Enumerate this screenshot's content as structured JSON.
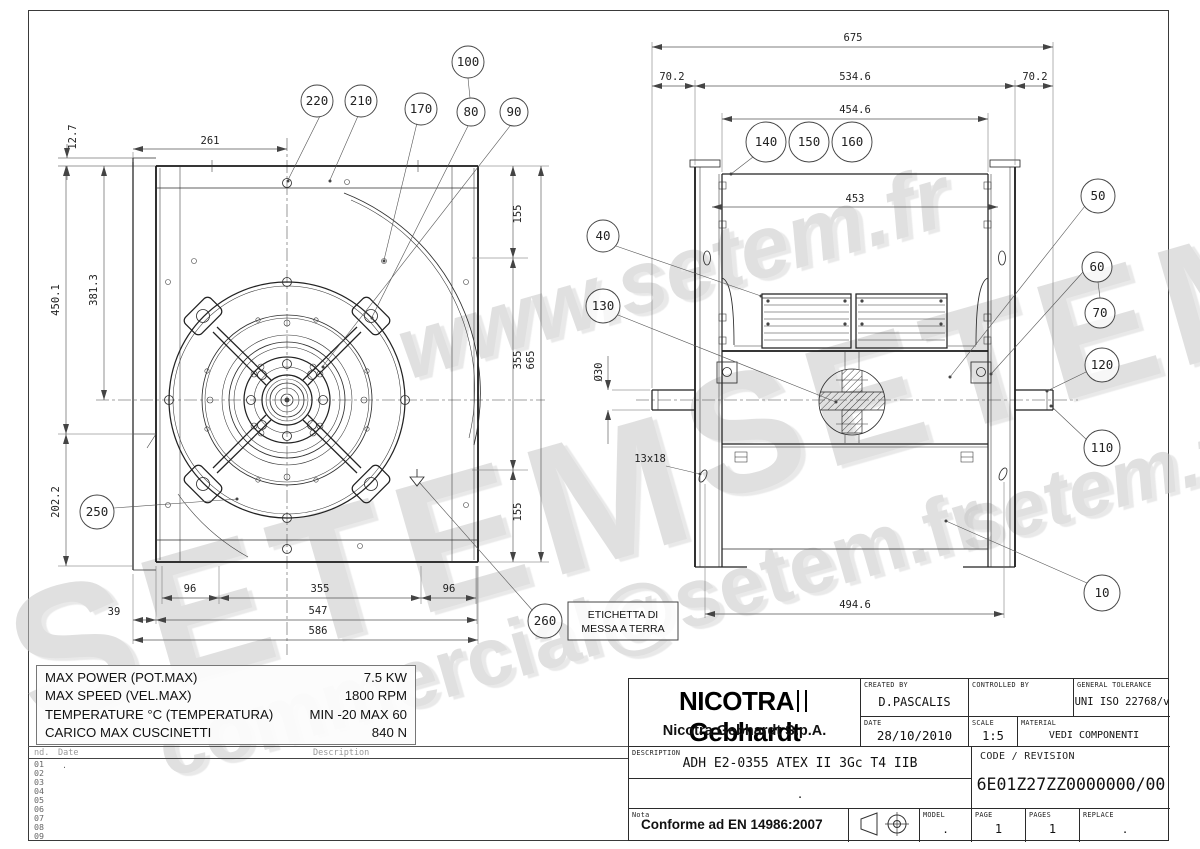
{
  "watermarks": {
    "w1": "www.setem.fr",
    "w2": "SETEM",
    "w3": "SETEM",
    "w4": "commercial@setem.fr",
    "w5": "setem.fr"
  },
  "front_view": {
    "balloons": {
      "b220": "220",
      "b210": "210",
      "b170": "170",
      "b80": "80",
      "b90": "90",
      "b100": "100",
      "b250": "250",
      "b260": "260"
    },
    "dims": {
      "d12_7": "12.7",
      "d261": "261",
      "d450": "450.1",
      "d381": "381.3",
      "d202": "202.2",
      "d155t": "155",
      "d355r": "355",
      "d155b": "155",
      "d665": "665",
      "d96l": "96",
      "d355b": "355",
      "d96r": "96",
      "d39": "39",
      "d547": "547",
      "d586": "586"
    },
    "ground_label_1": "ETICHETTA DI",
    "ground_label_2": "MESSA A TERRA"
  },
  "side_view": {
    "balloons": {
      "b140": "140",
      "b150": "150",
      "b160": "160",
      "b40": "40",
      "b130": "130",
      "b50": "50",
      "b60": "60",
      "b70": "70",
      "b120": "120",
      "b110": "110",
      "b10": "10"
    },
    "dims": {
      "d675": "675",
      "d70l": "70.2",
      "d534": "534.6",
      "d70r": "70.2",
      "d454": "454.6",
      "d453": "453",
      "d30": "Ø30",
      "d13": "13x18",
      "d494": "494.6"
    }
  },
  "spec_table": {
    "rows": [
      {
        "label": "MAX POWER (POT.MAX)",
        "value": "7.5 KW"
      },
      {
        "label": "MAX SPEED (VEL.MAX)",
        "value": "1800 RPM"
      },
      {
        "label": "TEMPERATURE °C (TEMPERATURA)",
        "value": "MIN -20 MAX 60"
      },
      {
        "label": "CARICO MAX CUSCINETTI",
        "value": "840 N"
      }
    ]
  },
  "revision_table": {
    "col_index": "nd.",
    "col_date": "Date",
    "col_desc": "Description",
    "rows": [
      "01",
      "02",
      "03",
      "04",
      "05",
      "06",
      "07",
      "08",
      "09"
    ],
    "row1_entry": "."
  },
  "title_block": {
    "brand_left": "NICOTRA",
    "brand_right": "Gebhardt",
    "company": "Nicotra Gebhardt S.p.A.",
    "created_by_label": "CREATED BY",
    "created_by": "D.PASCALIS",
    "controlled_by_label": "CONTROLLED BY",
    "controlled_by": "",
    "tolerance_label": "GENERAL TOLERANCE",
    "tolerance": "UNI ISO 22768/v",
    "date_label": "DATE",
    "date": "28/10/2010",
    "scale_label": "SCALE",
    "scale": "1:5",
    "material_label": "MATERIAL",
    "material": "VEDI COMPONENTI",
    "description_label": "DESCRIPTION",
    "description": "ADH E2-0355 ATEX II 3Gc T4 IIB",
    "description_row2": ".",
    "code_label": "CODE / REVISION",
    "code": "6E01Z27ZZ0000000/00",
    "nota_label": "Nota",
    "nota": "Conforme ad EN 14986:2007",
    "model_label": "MODEL",
    "model": ".",
    "page_label": "PAGE",
    "page": "1",
    "pages_label": "PAGES",
    "pages": "1",
    "replace_label": "REPLACE",
    "replace": "."
  }
}
